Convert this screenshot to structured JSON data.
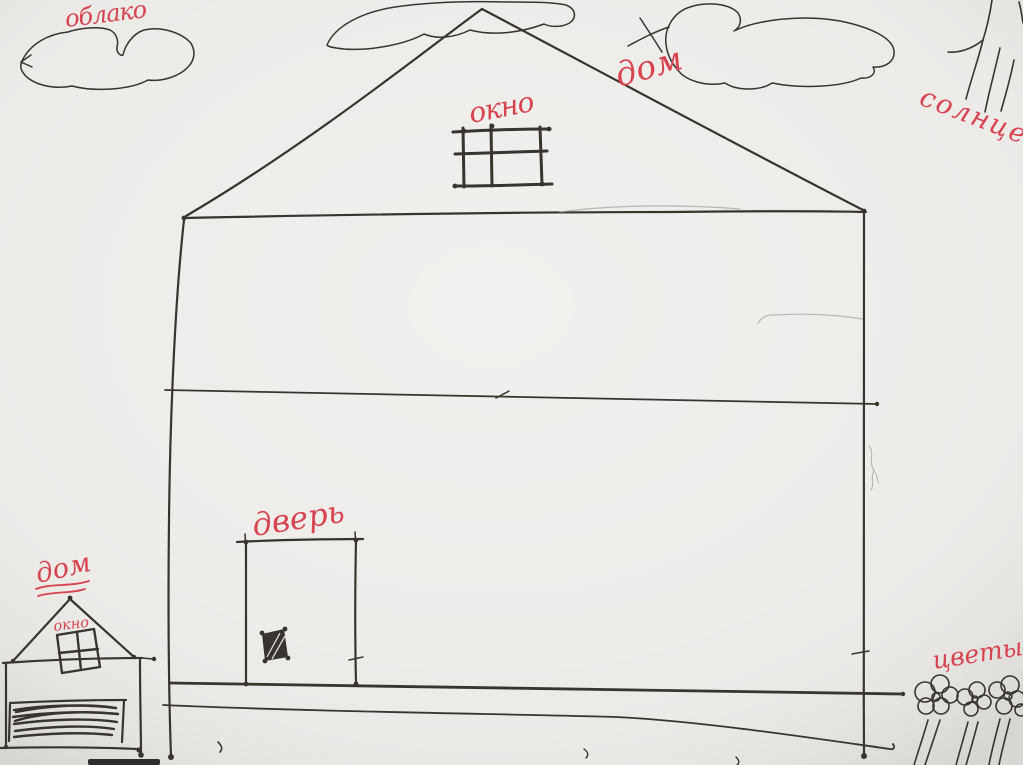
{
  "drawing": {
    "colors": {
      "paper": "#eceae7",
      "ink": "#38342f",
      "pencil": "#aaa8a3",
      "label_red": "#d84350"
    },
    "labels": {
      "cloud": "облако",
      "house": "дом",
      "window": "окно",
      "sun": "солнце",
      "door": "дверь",
      "small_house": "дом",
      "small_house_window": "окно",
      "flowers": "цветы"
    }
  }
}
